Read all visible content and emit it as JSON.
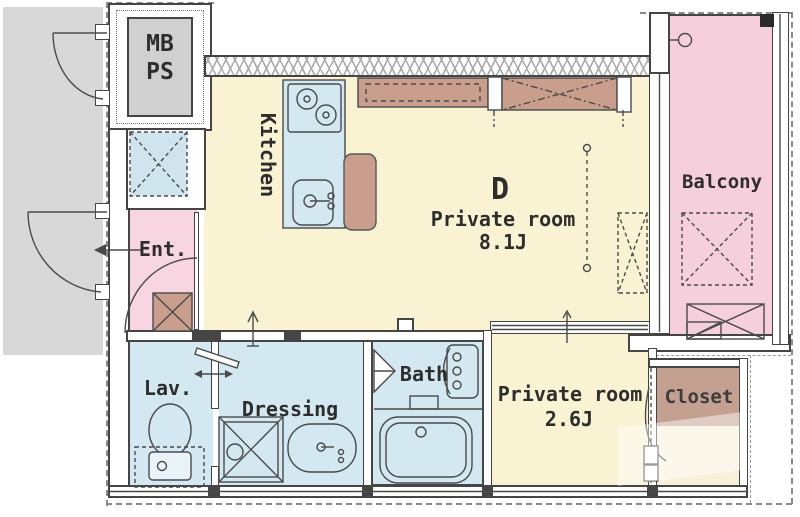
{
  "floorplan": {
    "rooms": {
      "mb_ps": {
        "line1": "MB",
        "line2": "PS"
      },
      "kitchen": {
        "label": "Kitchen"
      },
      "main_room": {
        "letter": "D",
        "name": "Private room",
        "size": "8.1J"
      },
      "balcony": {
        "label": "Balcony"
      },
      "entrance": {
        "label": "Ent."
      },
      "lavatory": {
        "label": "Lav."
      },
      "dressing": {
        "label": "Dressing"
      },
      "bath": {
        "label": "Bath"
      },
      "bedroom": {
        "name": "Private room",
        "size": "2.6J"
      },
      "closet": {
        "label": "Closet"
      }
    },
    "colors": {
      "room_yellow": "#faf3d3",
      "wet_blue": "#d3e8f0",
      "pink": "#f8d6e1",
      "balcony_pink": "#f6cfdd",
      "fixture_tan": "#c99e8c",
      "closet_tan": "#c4a091",
      "exterior_gray": "#d8d8d8",
      "wall_dark": "#454545"
    }
  }
}
